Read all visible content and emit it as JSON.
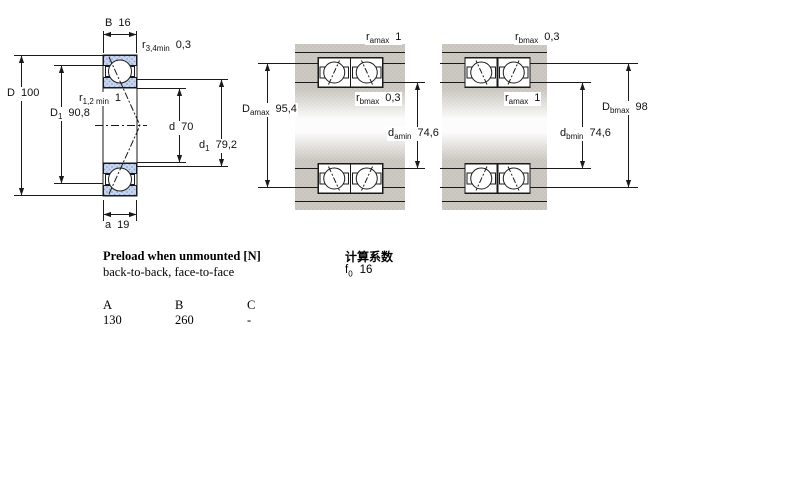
{
  "colors": {
    "line": "#1a1a1a",
    "housing_gray": "#cdcac3",
    "housing_dot": "#bfbbb2",
    "ring_blue": "#c7d6ee",
    "ring_dot": "#8ea5d0"
  },
  "diagrams": {
    "single": {
      "name": "single bearing cross-section",
      "dims": {
        "B": {
          "sym": "B",
          "val": "16"
        },
        "r34": {
          "sym": "r",
          "sub": "3,4min",
          "val": "0,3"
        },
        "D": {
          "sym": "D",
          "val": "100"
        },
        "r12": {
          "sym": "r",
          "sub": "1,2 min",
          "val": "1"
        },
        "D1": {
          "sym": "D",
          "sub": "1",
          "val": "90,8"
        },
        "d": {
          "sym": "d",
          "val": "70"
        },
        "d1": {
          "sym": "d",
          "sub": "1",
          "val": "79,2"
        },
        "a": {
          "sym": "a",
          "val": "19"
        }
      }
    },
    "back_to_back": {
      "name": "paired bearings back-to-back",
      "dims": {
        "ramax": {
          "sym": "r",
          "sub": "amax",
          "val": "1"
        },
        "rbmax": {
          "sym": "r",
          "sub": "bmax",
          "val": "0,3"
        },
        "Damax": {
          "sym": "D",
          "sub": "amax",
          "val": "95,4"
        },
        "damin": {
          "sym": "d",
          "sub": "amin",
          "val": "74,6"
        }
      }
    },
    "face_to_face": {
      "name": "paired bearings face-to-face",
      "dims": {
        "rbmax": {
          "sym": "r",
          "sub": "bmax",
          "val": "0,3"
        },
        "ramax": {
          "sym": "r",
          "sub": "amax",
          "val": "1"
        },
        "Dbmax": {
          "sym": "D",
          "sub": "bmax",
          "val": "98"
        },
        "dbmin": {
          "sym": "d",
          "sub": "bmin",
          "val": "74,6"
        }
      }
    }
  },
  "preload": {
    "title": "Preload when unmounted [N]",
    "subtitle": "back-to-back, face-to-face",
    "columns": [
      "A",
      "B",
      "C"
    ],
    "values": [
      "130",
      "260",
      "-"
    ]
  },
  "calc": {
    "title": "计算系数",
    "factor": {
      "sym": "f",
      "sub": "0",
      "val": "16"
    }
  }
}
